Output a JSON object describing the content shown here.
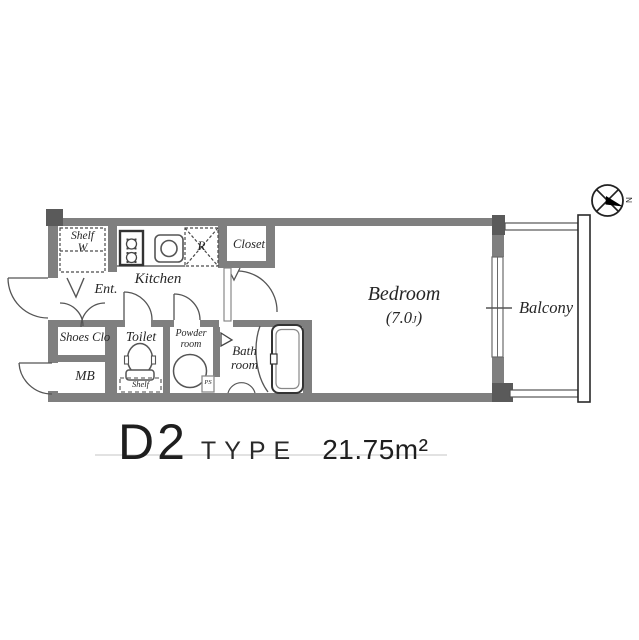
{
  "plan": {
    "caption": {
      "type_name": "D2",
      "type_word": "TYPE",
      "area": "21.75m²"
    },
    "rooms": {
      "bedroom_name": "Bedroom",
      "bedroom_size_prefix": "(7.0",
      "bedroom_size_unit": "J",
      "bedroom_size_suffix": ")",
      "balcony": "Balcony",
      "kitchen": "Kitchen",
      "closet": "Closet",
      "shelf_line1": "Shelf",
      "shelf_line2": "W",
      "refrigerator": "R",
      "entrance": "Ent.",
      "shoes_closet": "Shoes Clo",
      "meter_box": "MB",
      "toilet": "Toilet",
      "toilet_shelf": "Shelf",
      "powder_line1": "Powder",
      "powder_line2": "room",
      "pipe_space": "PS",
      "bath_line1": "Bath",
      "bath_line2": "room"
    },
    "compass": {
      "north": "N"
    }
  },
  "colors": {
    "wall": "#7f7f7f",
    "wall_dark": "#5a5a5a",
    "line": "#555555",
    "fixture_dark": "#333333",
    "text": "#262626",
    "caption_underline": "#e2e2e2"
  }
}
